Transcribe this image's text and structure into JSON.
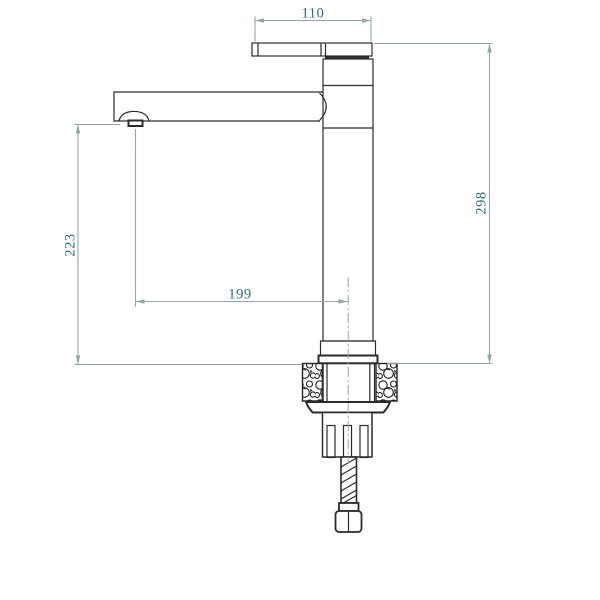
{
  "page": {
    "background": "#ffffff",
    "type": "technical-drawing",
    "subject": "tall single-lever basin mixer tap, side elevation with installation hardware"
  },
  "drawing": {
    "dimensions": {
      "handle_length": "110",
      "overall_height": "298",
      "spout_height": "223",
      "spout_reach": "199"
    },
    "colors": {
      "outline": "#2b2b2b",
      "dimension_line": "#8fa8ac",
      "dimension_text": "#20707c",
      "centerline": "#9aa4a4",
      "background": "#ffffff"
    },
    "parts": [
      "lever-handle",
      "cartridge-housing",
      "swivel-spout",
      "aerator-nozzle",
      "body-column",
      "base-flange",
      "countertop-cross-section",
      "gasket",
      "mounting-nut",
      "threaded-supply-hose",
      "hose-coupling-nut",
      "vertical-centerline"
    ]
  }
}
